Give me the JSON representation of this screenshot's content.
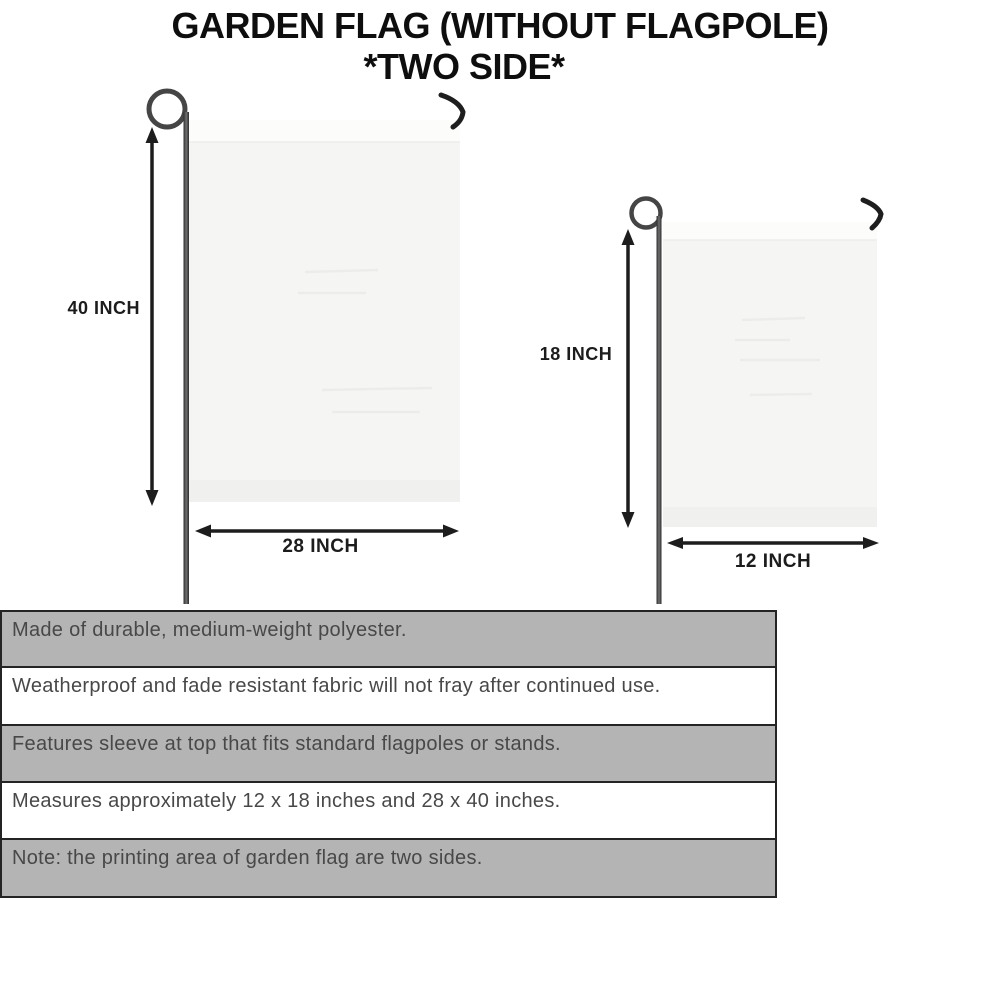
{
  "title": {
    "line1": "GARDEN FLAG (WITHOUT FLAGPOLE)",
    "line2": "*TWO SIDE*"
  },
  "flags": {
    "large": {
      "height_label": "40 INCH",
      "width_label": "28 INCH"
    },
    "small": {
      "height_label": "18 INCH",
      "width_label": "12 INCH"
    }
  },
  "features": [
    {
      "text": "Made of durable, medium-weight polyester.",
      "background": "gray"
    },
    {
      "text": "Weatherproof and fade resistant fabric will not fray after continued use.",
      "background": "white"
    },
    {
      "text": "Features sleeve at top that fits standard flagpoles or stands.",
      "background": "gray"
    },
    {
      "text": "Measures approximately 12 x 18 inches and 28 x 40 inches.",
      "background": "white"
    },
    {
      "text": "Note: the printing area of garden flag are two sides.",
      "background": "gray"
    }
  ],
  "colors": {
    "stripe_gray": "#b4b4b4",
    "stripe_border": "#242424",
    "title_color": "#0e0e0e",
    "feature_text": "#484848",
    "arrow_color": "#1c1c1c",
    "flag_fill": "#f5f5f4"
  }
}
